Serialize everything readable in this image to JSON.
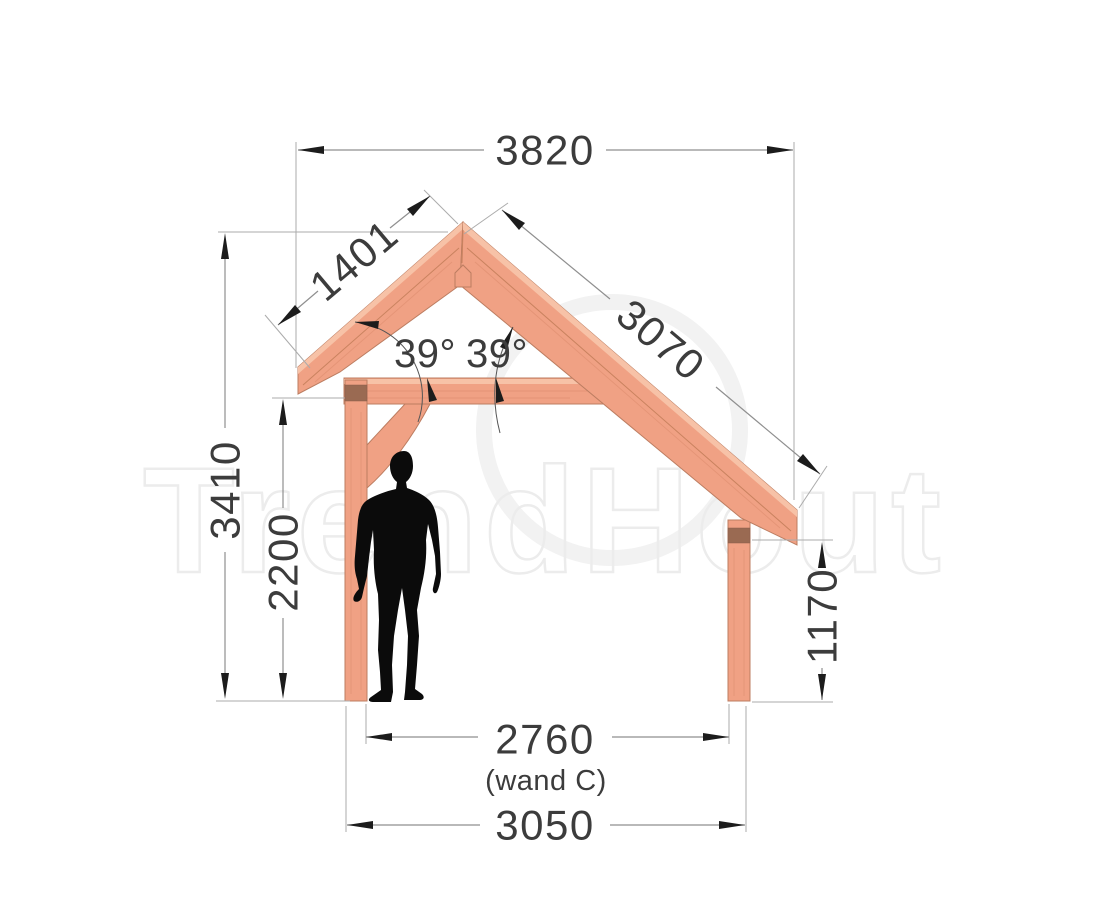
{
  "drawing": {
    "type": "side-elevation construction drawing of a wooden lean-to veranda frame",
    "watermark": {
      "text": "TrendHout"
    },
    "dims": {
      "roof_span": "3820",
      "left_roof": "1401",
      "right_roof": "3070",
      "angle_left": "39°",
      "angle_right": "39°",
      "ridge_height": "3410",
      "clear_height": "2200",
      "low_post_height": "1170",
      "inner_span": "2760",
      "inner_span_note": "(wand C)",
      "outer_span": "3050"
    },
    "colors": {
      "background": "#ffffff",
      "wood_face": "#f0a184",
      "wood_top_highlight": "#f7c2a7",
      "wood_edge": "#bc7d61",
      "hardware_band": "#9a6a52",
      "dimension_line": "#8f8f8f",
      "extension_line": "#ababab",
      "arrow": "#1c1c1c",
      "dimension_text": "#3c3c3c",
      "human_figure": "#0b0b0b",
      "watermark": "#ececec"
    }
  }
}
